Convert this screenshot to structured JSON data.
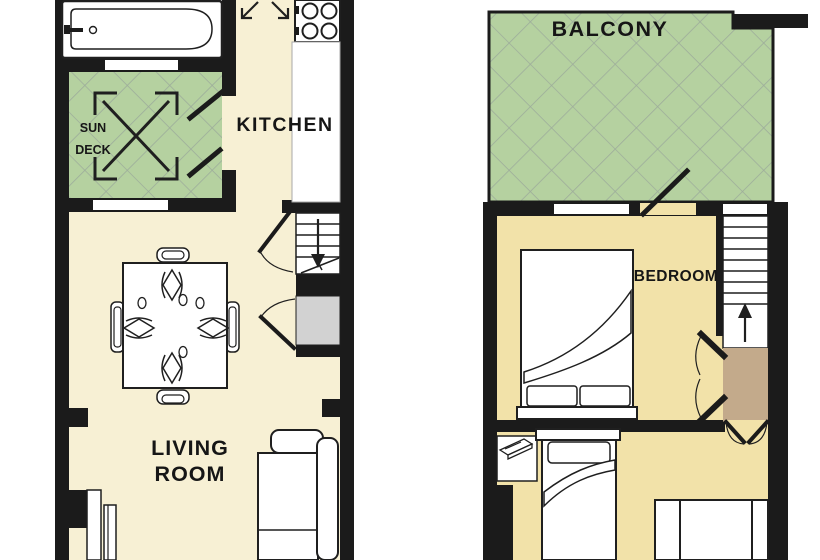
{
  "document": {
    "type": "floor-plan",
    "background": "#ffffff"
  },
  "colors": {
    "wall": "#1b1b1b",
    "line": "#1f1f1f",
    "text": "#161616",
    "floor_cream": "#f7f0d4",
    "floor_tan": "#f2e2a9",
    "deck_green": "#b5d1a0",
    "hatch_line": "#9dac9b",
    "landing_brown": "#c3aa8b",
    "closet_gray": "#d2d2d2"
  },
  "floors": {
    "lower": {
      "labels": {
        "kitchen": "KITCHEN",
        "sun_deck": [
          "SUN",
          "DECK"
        ],
        "living_room": [
          "LIVING",
          "ROOM"
        ]
      },
      "features": [
        "bathtub",
        "entry-arrows",
        "stove-hob",
        "kitchen-counter",
        "sun-deck-decking-cross",
        "stairs-down",
        "storage-closet",
        "dining-table-with-four-chairs",
        "sofa",
        "panel-doors"
      ]
    },
    "upper": {
      "labels": {
        "balcony": "BALCONY",
        "bedroom": "BEDROOM"
      },
      "features": [
        "balcony-terrace",
        "double-bed",
        "stairs-up",
        "landing",
        "double-doors",
        "desk",
        "single-bed",
        "second-bed"
      ]
    }
  }
}
